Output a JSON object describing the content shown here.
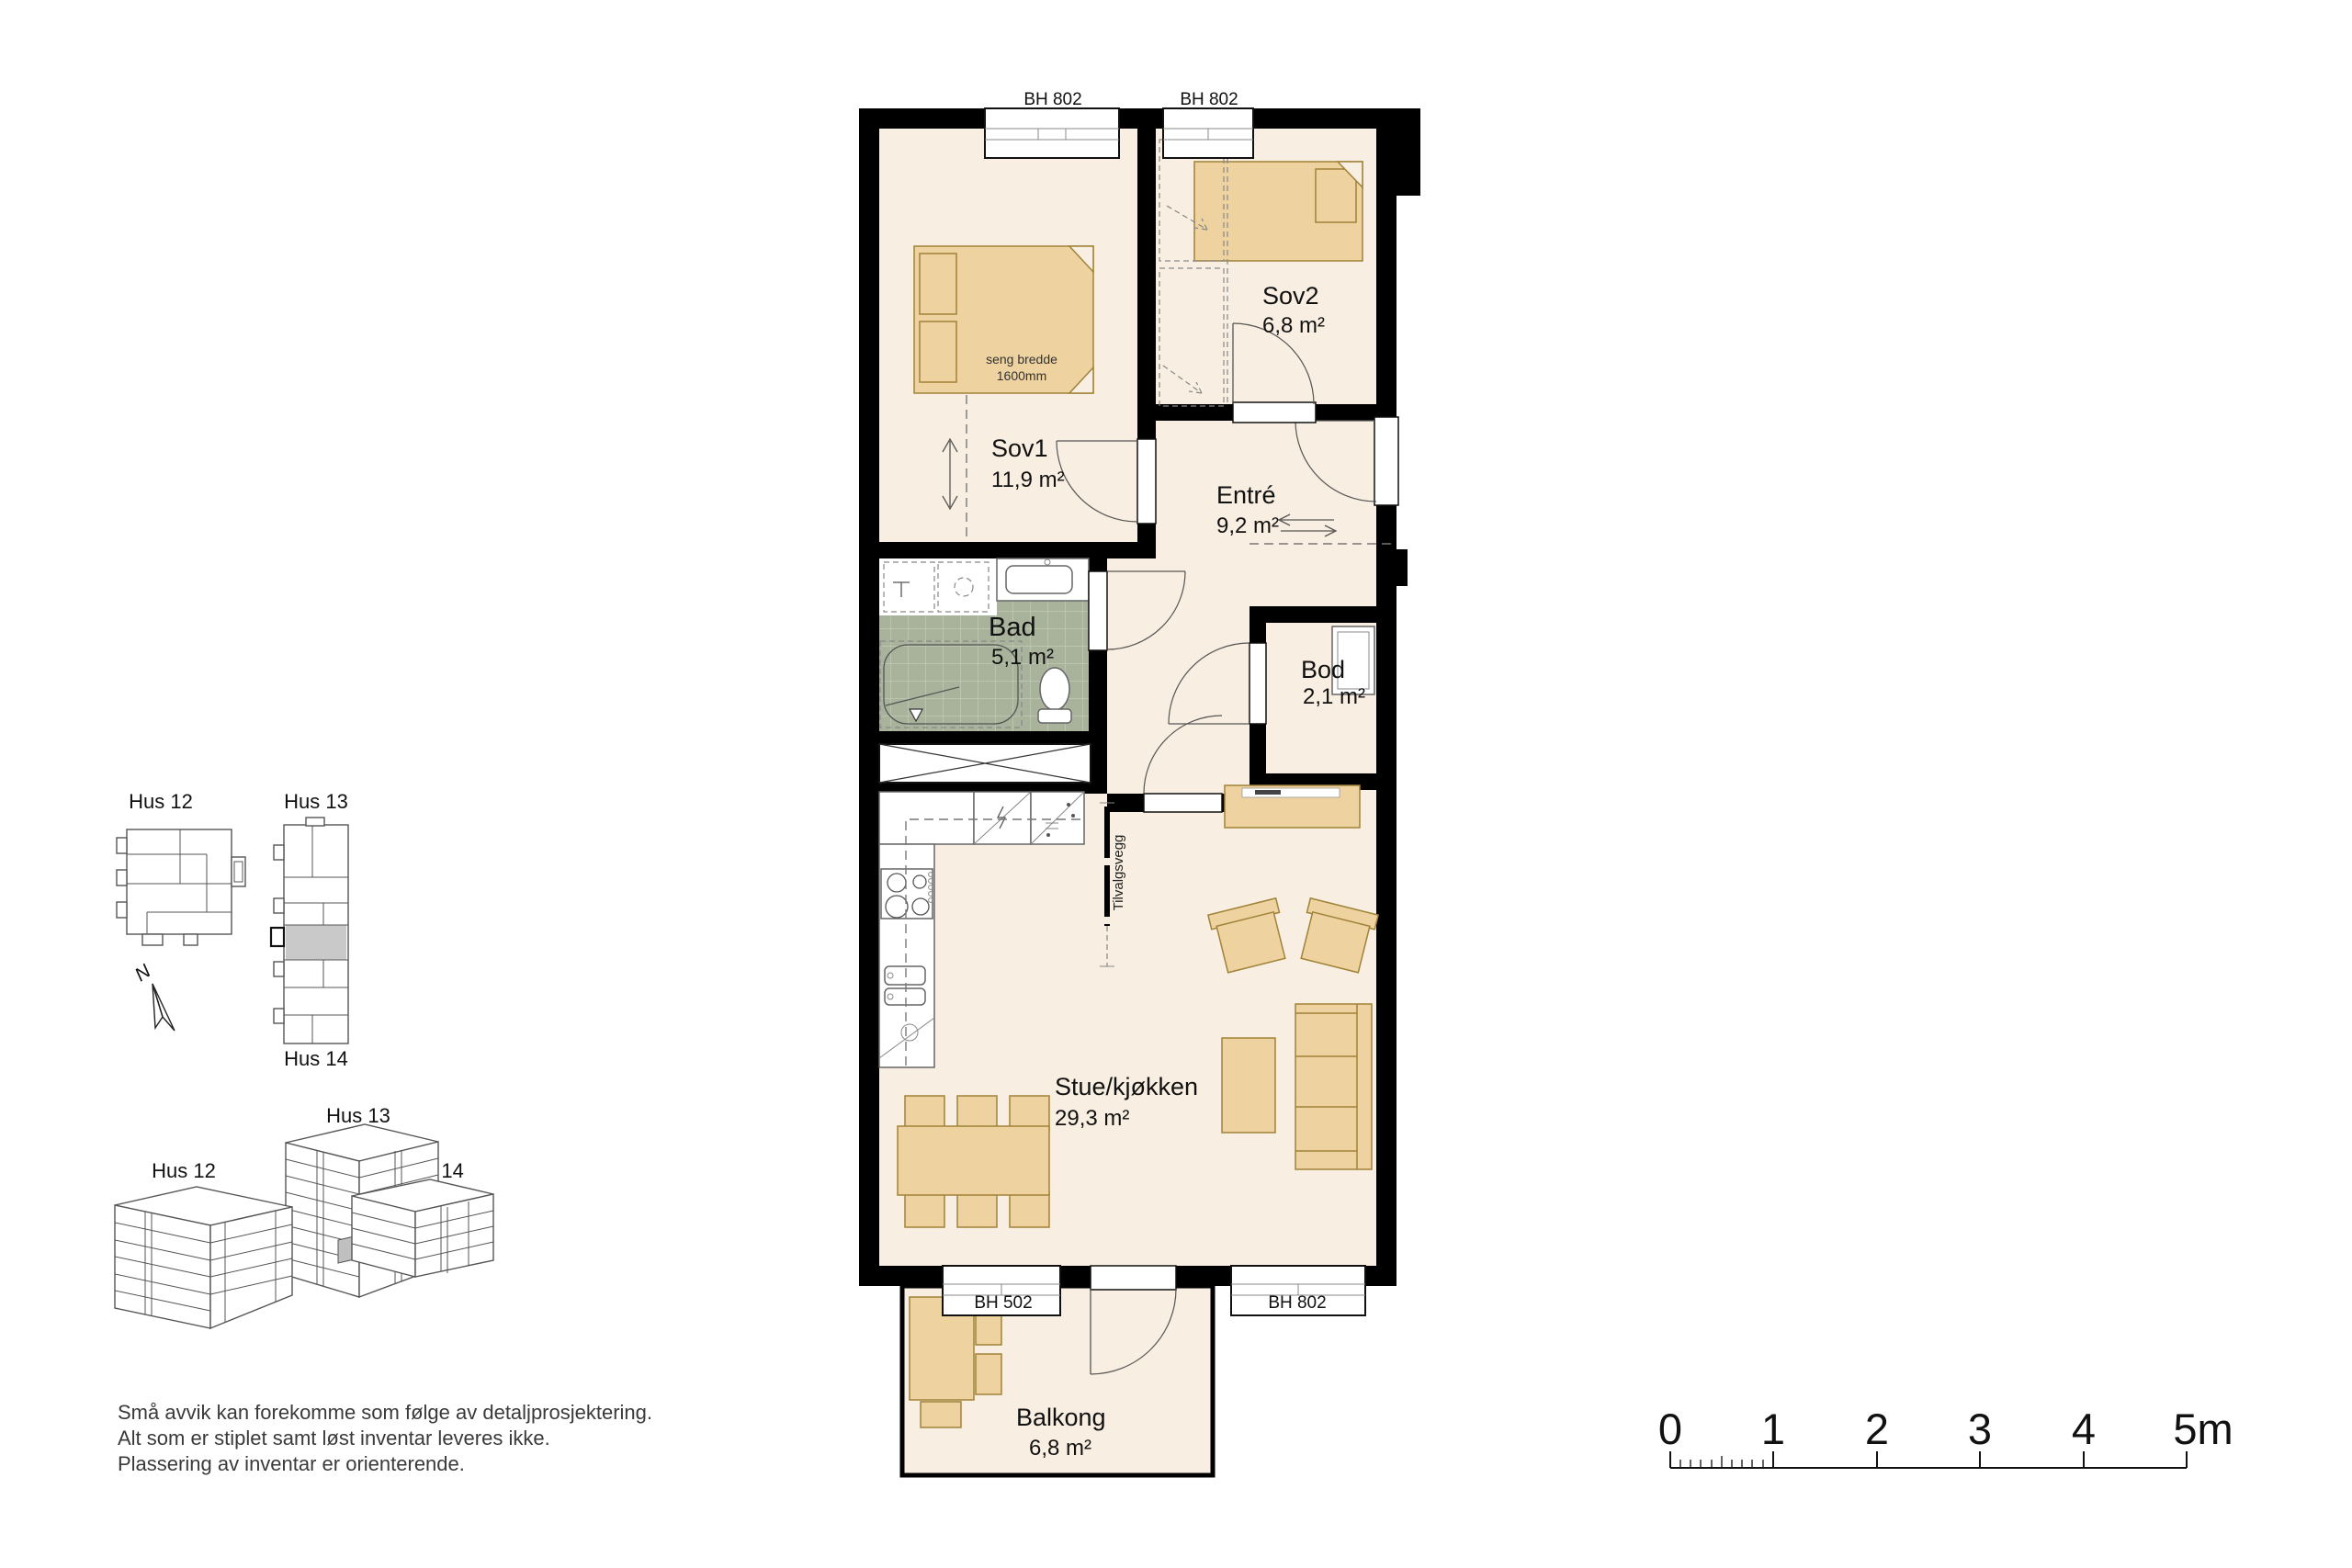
{
  "floor_plan": {
    "window_height_labels": {
      "top_left": "BH 802",
      "top_right": "BH 802",
      "balcony": "BH 502",
      "bottom_right": "BH 802"
    },
    "rooms": {
      "sov1": {
        "name": "Sov1",
        "area": "11,9 m²"
      },
      "sov2": {
        "name": "Sov2",
        "area": "6,8 m²"
      },
      "entre": {
        "name": "Entré",
        "area": "9,2 m²"
      },
      "bad": {
        "name": "Bad",
        "area": "5,1 m²"
      },
      "bod": {
        "name": "Bod",
        "area": "2,1 m²"
      },
      "stue": {
        "name": "Stue/kjøkken",
        "area": "29,3 m²"
      },
      "balkong": {
        "name": "Balkong",
        "area": "6,8 m²"
      }
    },
    "annotations": {
      "bed_width_line1": "seng bredde",
      "bed_width_line2": "1600mm",
      "optional_wall": "Tilvalgsvegg"
    }
  },
  "site_plan": {
    "hus12_label": "Hus 12",
    "hus13_label": "Hus 13",
    "hus14_label": "Hus 14",
    "north_label": "N"
  },
  "isometric": {
    "hus12_label": "Hus 12",
    "hus13_label": "Hus 13",
    "hus14_label": "Hus 14"
  },
  "disclaimer": {
    "line1": "Små avvik kan forekomme som følge av detaljprosjektering.",
    "line2": "Alt som er stiplet samt løst inventar leveres ikke.",
    "line3": "Plassering av inventar er orienterende."
  },
  "scale_bar": {
    "labels": [
      "0",
      "1",
      "2",
      "3",
      "4",
      "5m"
    ]
  },
  "colors": {
    "wall": "#000000",
    "floor": "#f8eee1",
    "furniture_fill": "#eed2a0",
    "furniture_stroke": "#a08238",
    "bath_floor": "#a9b29b",
    "highlight_gray": "#c9c9c9"
  }
}
